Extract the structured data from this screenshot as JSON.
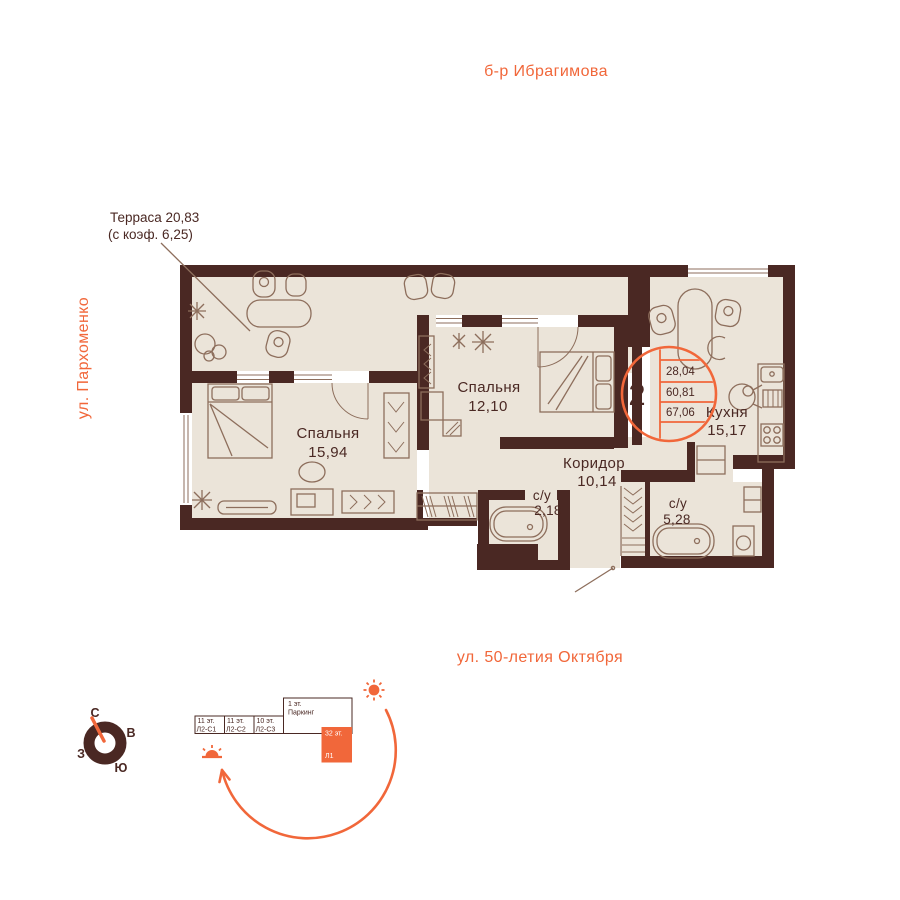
{
  "streets": {
    "top": "б-р Ибрагимова",
    "left": "ул. Пархоменко",
    "bottom": "ул. 50-летия Октября"
  },
  "terrace": {
    "label": "Терраса 20,83",
    "coef": "(с коэф. 6,25)"
  },
  "rooms": {
    "bedroom1": {
      "name": "Спальня",
      "area": "15,94"
    },
    "bedroom2": {
      "name": "Спальня",
      "area": "12,10"
    },
    "corridor": {
      "name": "Коридор",
      "area": "10,14"
    },
    "bath_small": {
      "name": "с/у",
      "area": "2,18"
    },
    "bath_big": {
      "name": "с/у",
      "area": "5,28"
    },
    "kitchen": {
      "name": "Кухня",
      "area": "15,17"
    }
  },
  "badge": {
    "rooms_count": "2",
    "area_living": "28,04",
    "area_main": "60,81",
    "area_total": "67,06"
  },
  "compass": {
    "north": "С",
    "east": "В",
    "south": "Ю",
    "west": "З"
  },
  "site_plan": {
    "blocks": [
      {
        "floors": "11 эт.",
        "label": "Л2-С1"
      },
      {
        "floors": "11 эт.",
        "label": "Л2-С2"
      },
      {
        "floors": "10 эт.",
        "label": "Л2-С3"
      },
      {
        "floors": "1 эт.",
        "label": "Паркинг"
      },
      {
        "floors": "32 эт.",
        "label": "Л1"
      }
    ]
  },
  "colors": {
    "accent": "#f1673a",
    "wall": "#4a2823",
    "floor": "#ebe4d9",
    "furniture": "#8d6e5c"
  }
}
